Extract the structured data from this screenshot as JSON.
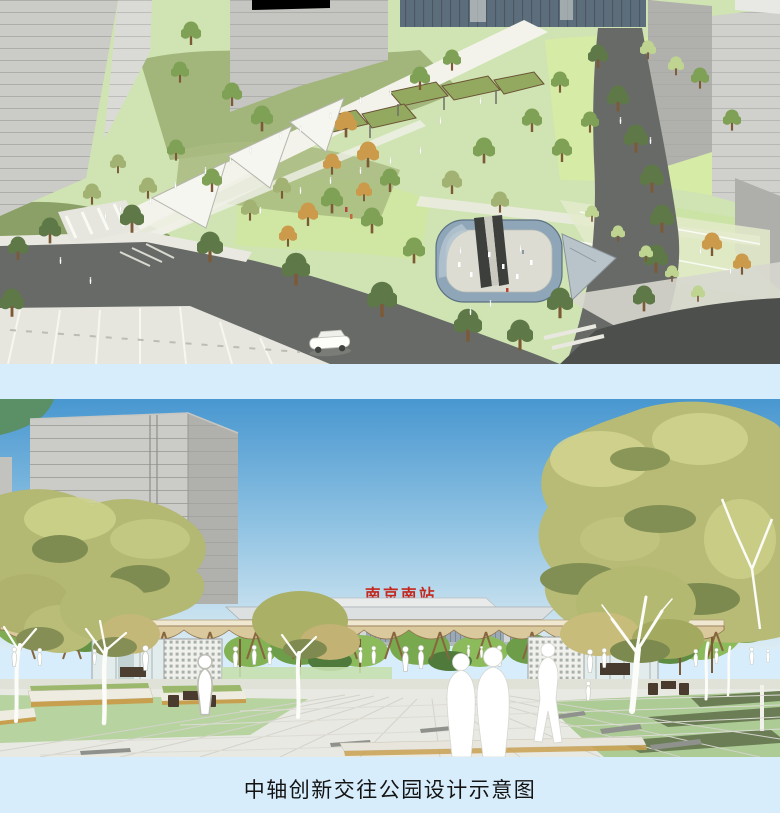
{
  "page": {
    "caption": "中轴创新交往公园设计示意图"
  },
  "plaza_view": {
    "station_sign": "南京南站"
  },
  "colors": {
    "page_bg": "#d7edfb",
    "caption_text": "#141414",
    "station_sign_red": "#c4271c",
    "sky_top": "#4897d0",
    "sky_mid": "#8fc2e2",
    "sky_horizon": "#dcecf4",
    "building_front": "#cbcbc7",
    "building_side": "#b0b0ac",
    "glass_band": "#5c6d7b",
    "park_base": "#cfe4b2",
    "lawn_bright": "#d6eba6",
    "lawn_plaza": "#b7d3a0",
    "tree_green": "#7fa156",
    "tree_olive": "#a2b272",
    "tree_dark": "#5e7947",
    "tree_autumn": "#cc9a4b",
    "foliage_yellow": "#b3b873",
    "road": "#676a66",
    "road_dark": "#4c4f4b",
    "path_light": "#f3f3ec",
    "pavement": "#e9e9e3",
    "wood_roof": "#dbc99e",
    "wood_frame": "#87663f",
    "pit_glass": "#8ea6b8",
    "figure_white": "#ffffff"
  }
}
